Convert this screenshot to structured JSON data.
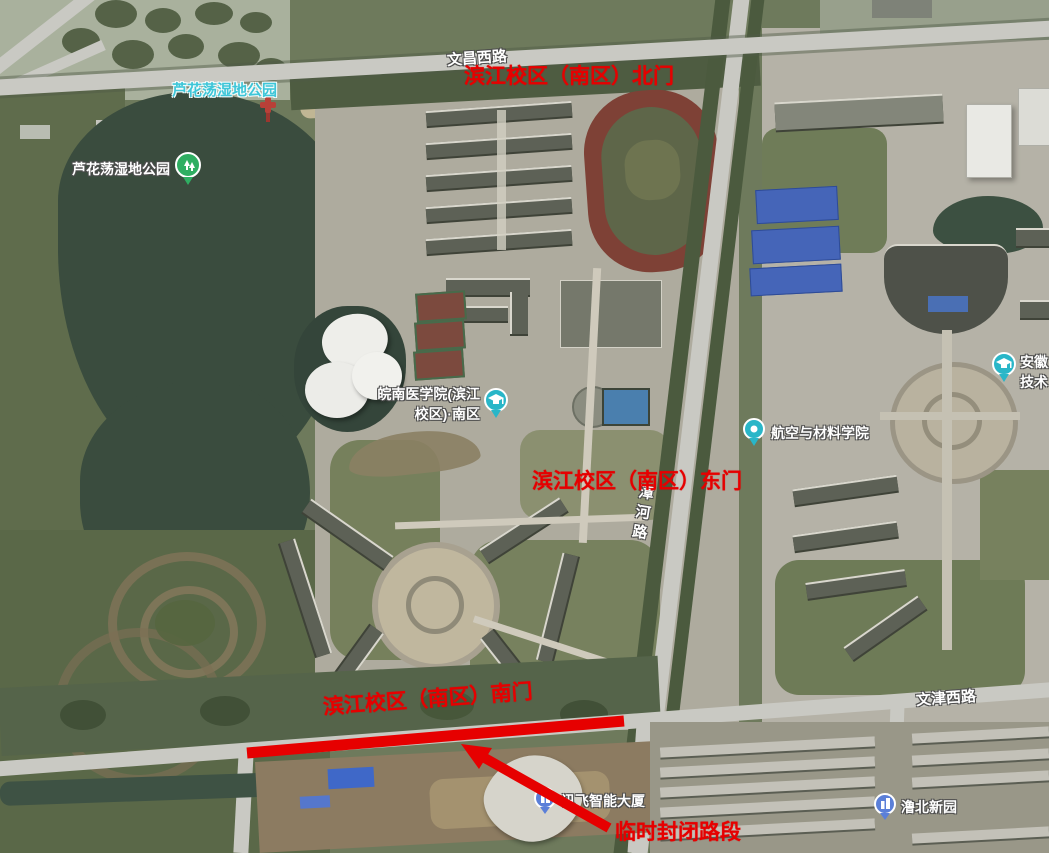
{
  "annotations": {
    "color": "#e60000",
    "north_gate_label": "滨江校区（南区）北门",
    "east_gate_label": "滨江校区（南区）东门",
    "south_gate_label": "滨江校区（南区）南门",
    "closed_road_label": "临时封闭路段"
  },
  "roads": {
    "top_road": "文昌西路",
    "bottom_road": "文津西路",
    "vertical_road": "漳河路"
  },
  "pois": {
    "wetland_park_far": {
      "label": "芦花荡湿地公园"
    },
    "wetland_park_near": {
      "label": "芦花荡湿地公园"
    },
    "medical_college": {
      "line1": "皖南医学院(滨江",
      "line2": "校区)·南区"
    },
    "aero_materials_school": {
      "label": "航空与材料学院"
    },
    "tech_college_edge": {
      "line1": "安徽",
      "line2": "技术"
    },
    "iflytek_tower": {
      "label": "讯飞智能大厦"
    },
    "lubei_xinyuan": {
      "label": "澛北新园"
    }
  },
  "icon_colors": {
    "park_pin": "#2fae62",
    "college_pin": "#29b6c8",
    "building_pin": "#5b7fd8"
  }
}
